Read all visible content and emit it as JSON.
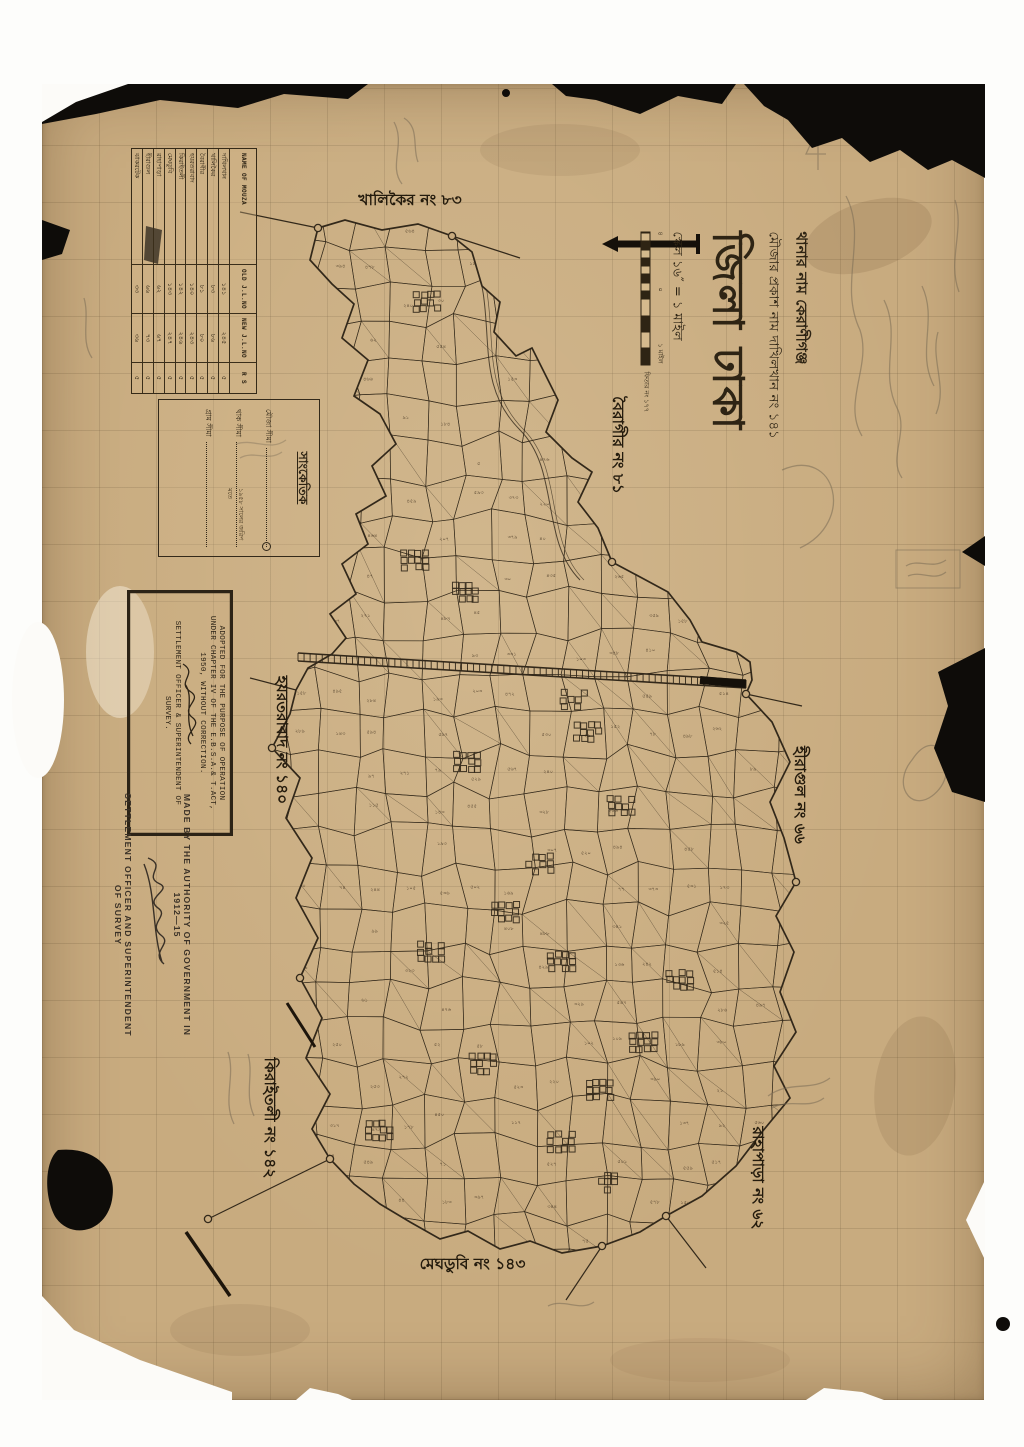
{
  "sheet": {
    "paper_color": "#c8ab7f",
    "ink_color": "#32281a",
    "pencil_color": "#7a6c55"
  },
  "title_block": {
    "thana_line": "থানার নাম কেরাণীগঞ্জ",
    "mouza_line": "মৌজার প্রকাশ নাম দাখিলখান নং ১৪১",
    "district_line": "জিলা ঢাকা",
    "scale_line": "স্কেল ১৬″ = ১ মাইল",
    "scale_ticks": [
      "৪",
      "০",
      "১ মাইল"
    ],
    "scale_note": "ফিতার নং ১৭৭"
  },
  "mouza_table": {
    "headers": [
      "NAME OF MOUZA",
      "OLD J.L.NO",
      "NEW J.L.NO",
      "R S"
    ],
    "rows": [
      [
        "দাখিলখান",
        "১৪১",
        "২৪৫",
        "৫"
      ],
      [
        "খালিকৈর",
        "৮৩",
        "৮৬",
        "৫"
      ],
      [
        "বৈরাগীর",
        "৮১",
        "৮০",
        "৫"
      ],
      [
        "হযরতরাবাদ",
        "১৪০",
        "২৪৩",
        "৫"
      ],
      [
        "কিরাইতলী",
        "১৪২",
        "২৪৬",
        "৫"
      ],
      [
        "মেঘডুবি",
        "১৪৩",
        "২৪৭",
        "৫"
      ],
      [
        "রাহাপাড়া",
        "৬২",
        "৬৭",
        "৫"
      ],
      [
        "হীরাগুল",
        "৬৬",
        "৭৩",
        "৫"
      ],
      [
        "ঝাকরটেক",
        "৩৩",
        "৩৬",
        "৫"
      ]
    ]
  },
  "legend": {
    "title": "সাংকেতিক",
    "items": [
      {
        "label": "মৌজা সীমা",
        "note": "",
        "circle_end": true
      },
      {
        "label": "থাক সীমা",
        "note": "১৯৫৮ সালের জরিপ মতে",
        "circle_end": false
      },
      {
        "label": "গ্রাম সীমা",
        "note": "",
        "circle_end": false
      }
    ]
  },
  "stamp": {
    "line1": "ADOPTED FOR THE PURPOSE OF OPERATION",
    "line2": "UNDER CHAPTER IV OF THE E.B.S.A.& T.ACT,",
    "line3": "1950, WITHOUT CORRECTION.",
    "line4": "SETTLEMENT OFFICER & SUPERINTENDENT OF",
    "line5": "SURVEY."
  },
  "authority": {
    "line1": "MADE BY THE AUTHORITY OF GOVERNMENT IN 1912—15",
    "line2": "SETTLEMENT OFFICER AND SUPERINTENDENT OF SURVEY"
  },
  "neighbor_labels": {
    "north": "খালিকৈর নং ৮৩",
    "northeast": "বৈরাগীর নং ৮১",
    "west": "হযরতরাবাদ নং ১৪০",
    "east": "হীরাগুল নং ৬৬",
    "southwest": "কিরাইতলী নং ১৪২",
    "southeast": "রাহাপাড়া নং ৬২",
    "south": "মেঘডুবি নং ১৪৩"
  }
}
